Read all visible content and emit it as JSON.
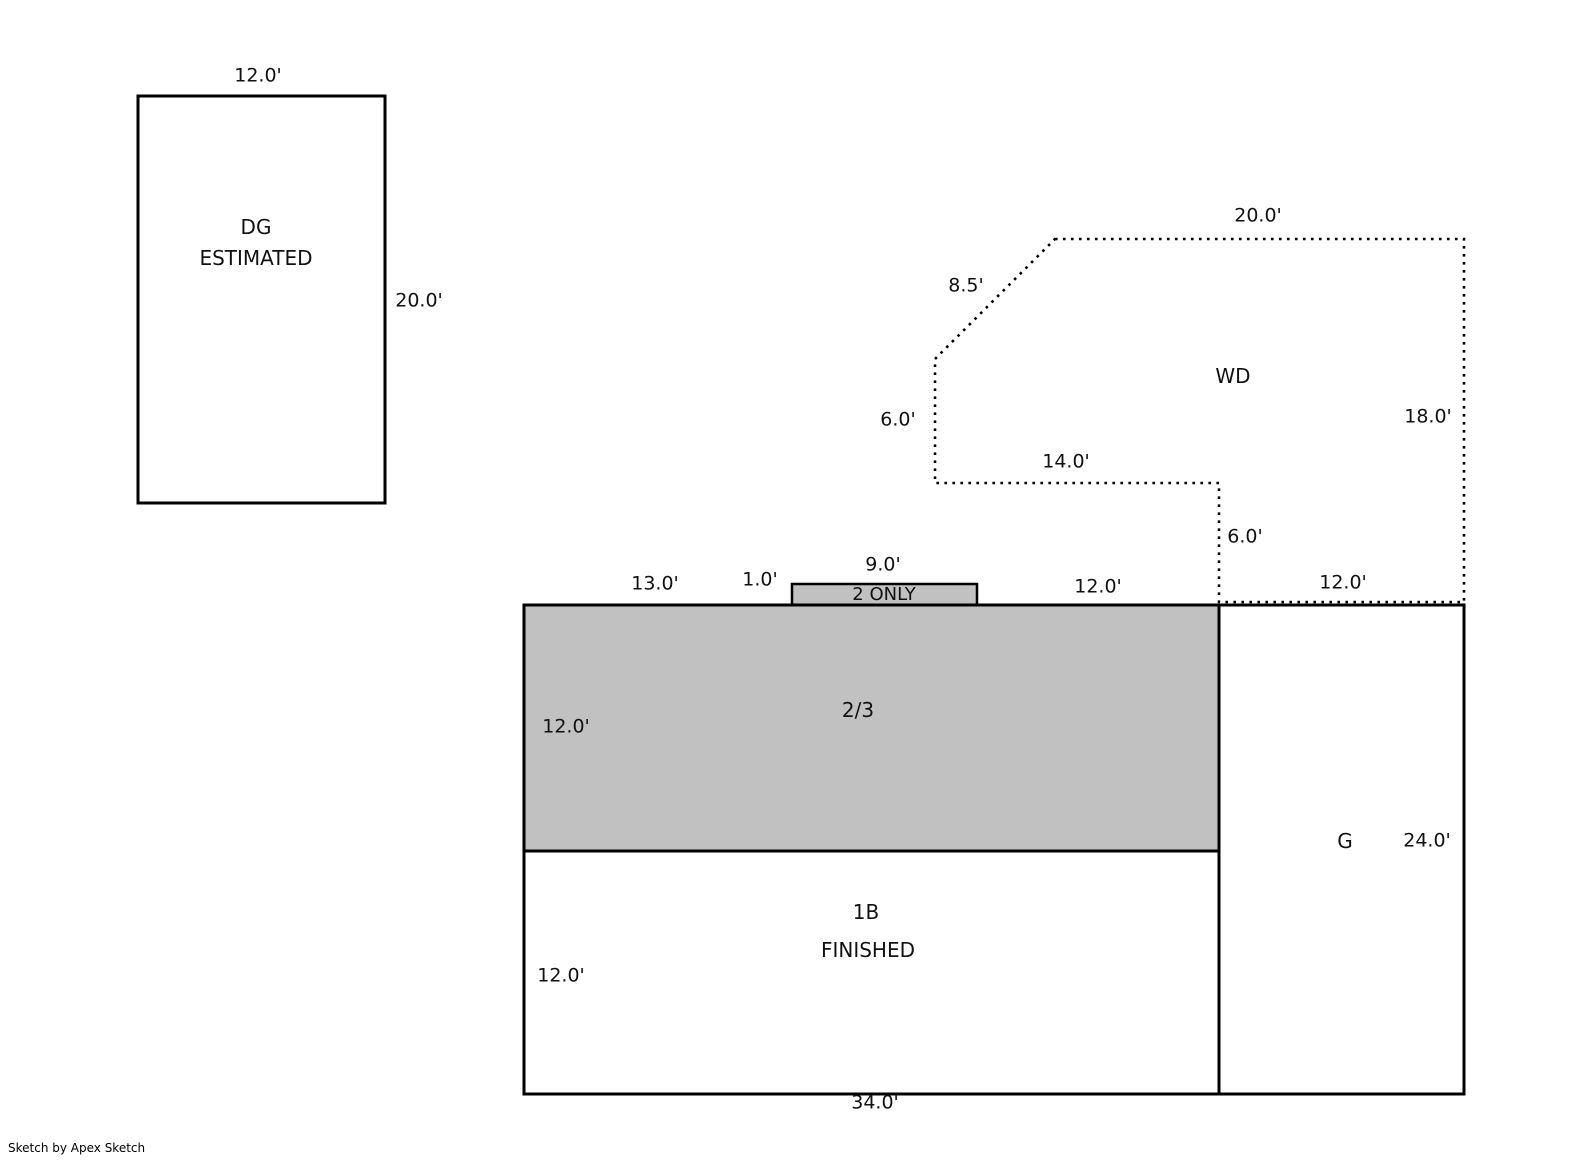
{
  "watermark": "Sketch by Apex Sketch",
  "colors": {
    "area_fill": "#c1c1c1",
    "line_color": "#000000"
  },
  "dg": {
    "name": "DG",
    "subtitle": "ESTIMATED",
    "top_dim": "12.0'",
    "right_dim": "20.0'"
  },
  "wd": {
    "name": "WD",
    "top_dim": "20.0'",
    "diagonal_dim": "8.5'",
    "left_dim": "6.0'",
    "inner_bottom_dim": "14.0'",
    "right_dim": "18.0'",
    "step_dim": "6.0'",
    "bottom_dim": "12.0'"
  },
  "upper_area": {
    "name": "2/3",
    "left_dim": "12.0'",
    "top_seg_13": "13.0'",
    "top_seg_1": "1.0'",
    "top_seg_9": "9.0'",
    "top_seg_12": "12.0'",
    "bump_label": "2 ONLY"
  },
  "lower_area": {
    "name": "1B",
    "subtitle": "FINISHED",
    "left_dim": "12.0'",
    "bottom_dim": "34.0'"
  },
  "garage": {
    "name": "G",
    "height_dim": "24.0'"
  }
}
